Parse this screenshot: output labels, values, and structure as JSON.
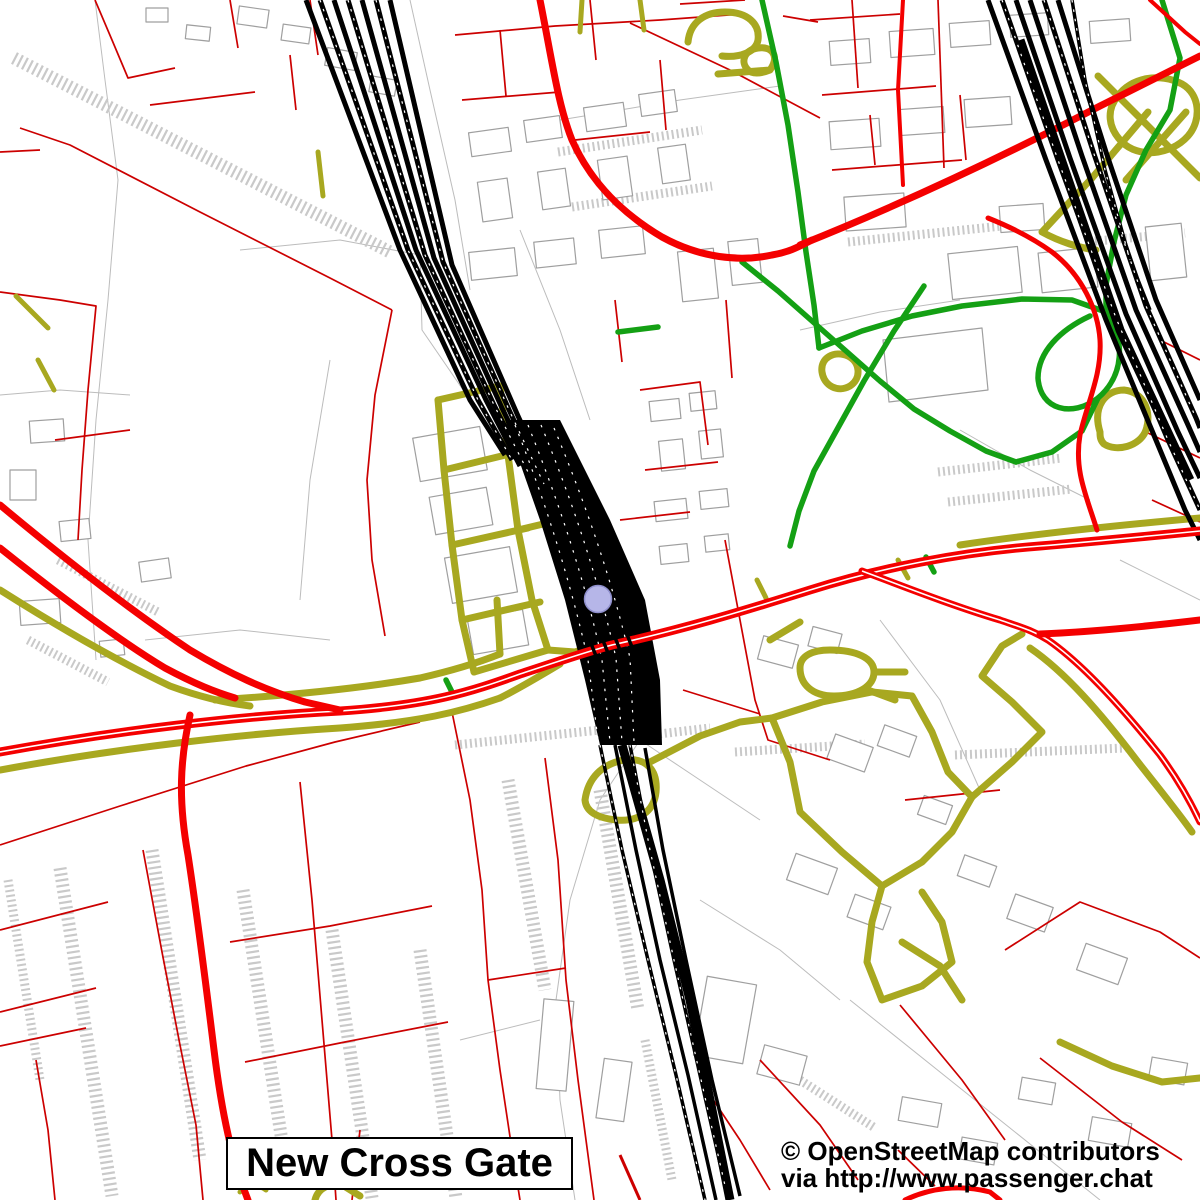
{
  "map": {
    "title_label": "New Cross Gate",
    "attribution": {
      "line1": "© OpenStreetMap contributors",
      "line2": "via http://www.passenger.chat"
    },
    "station_marker": {
      "shape": "circle"
    },
    "colors": {
      "background": "#ffffff",
      "main_road": "#f40000",
      "minor_road": "#cc0000",
      "tertiary_road": "#a8a820",
      "footpath": "#14a014",
      "railway": "#000000",
      "building_outline": "#9f9f9f",
      "parcel_line": "#bcbcbc",
      "terrace_texture": "#c9c9c9",
      "station_marker_fill": "#b6b6e8",
      "station_marker_border": "#8f8fcc",
      "label_text": "#000000",
      "label_box_background": "#ffffff",
      "label_box_border": "#000000"
    }
  }
}
